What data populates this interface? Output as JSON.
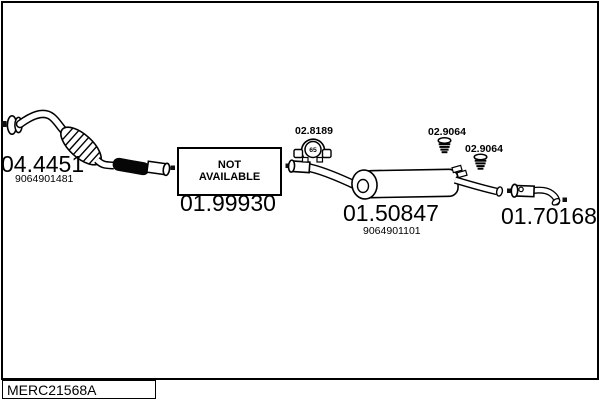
{
  "colors": {
    "ink": "#000000",
    "background": "#ffffff"
  },
  "parts": {
    "front_pipe": {
      "code": "04.4451",
      "oe_number": "9064901481"
    },
    "center_section": {
      "code": "01.99930",
      "status": [
        "NOT",
        "AVAILABLE"
      ]
    },
    "clamp": {
      "code": "02.8189",
      "diameter": "65"
    },
    "rear_muffler": {
      "code": "01.50847",
      "oe_number": "9064901101"
    },
    "hanger_front": {
      "code": "02.9064"
    },
    "hanger_rear": {
      "code": "02.9064"
    },
    "tail_pipe": {
      "code": "01.70168"
    }
  },
  "footer": {
    "drawing_code": "MERC21568A"
  }
}
